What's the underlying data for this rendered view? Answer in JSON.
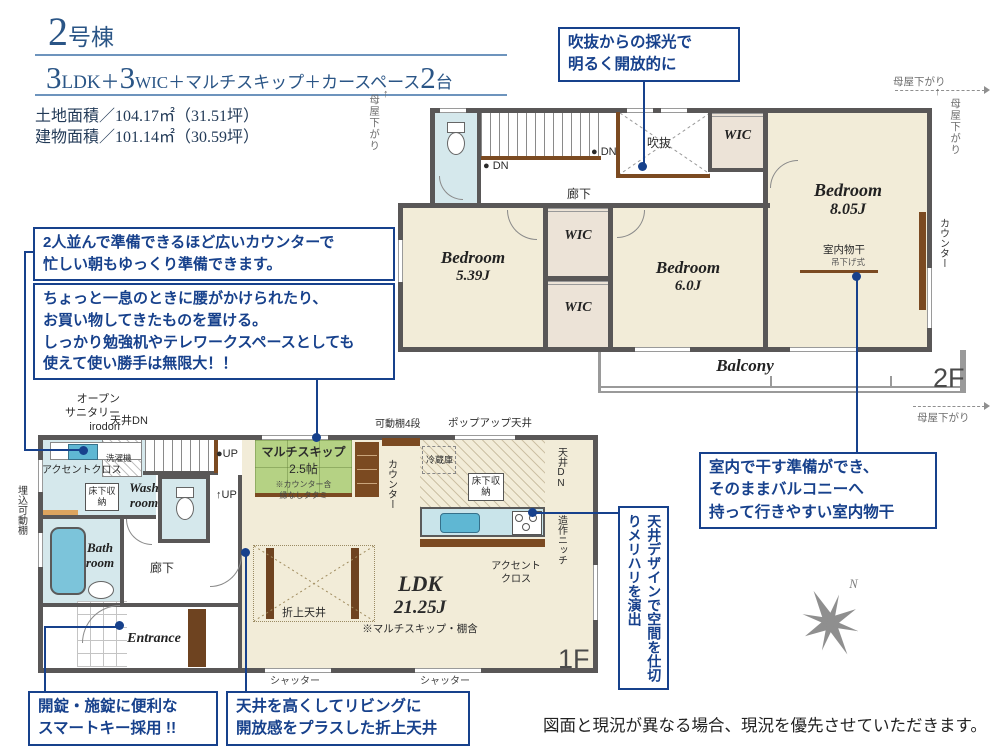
{
  "header": {
    "unit_number": "2",
    "unit_suffix": "号棟",
    "spec_num1": "3",
    "spec_txt1": "LDK＋",
    "spec_num2": "3",
    "spec_txt2": "WIC＋マルチスキップ＋カースペース",
    "spec_num3": "2",
    "spec_txt3": "台",
    "land_area": "土地面積／104.17㎡（31.51坪）",
    "building_area": "建物面積／101.14㎡（30.59坪）"
  },
  "callouts": {
    "void_light": "吹抜からの採光で\n明るく開放的に",
    "wide_counter": "2人並んで準備できるほど広いカウンターで\n忙しい朝もゆっくり準備できます。",
    "multi_skip_bench": "ちょっと一息のときに腰がかけられたり、\nお買い物してきたものを置ける。\nしっかり勉強机やテレワークスペースとしても\n使えて使い勝手は無限大！！",
    "indoor_drying": "室内で干す準備ができ、\nそのままバルコニーへ\n持って行きやすい室内物干",
    "ceiling_design": "天井デザインで空間を仕切りメリハリを演出",
    "smart_key": "開錠・施錠に便利な\nスマートキー採用 !!",
    "folded_ceiling": "天井を高くしてリビングに\n開放感をプラスした折上天井"
  },
  "plan2f": {
    "floor_label": "2F",
    "bedroom_a_name": "Bedroom",
    "bedroom_a_size": "8.05J",
    "bedroom_b_name": "Bedroom",
    "bedroom_b_size": "5.39J",
    "bedroom_c_name": "Bedroom",
    "bedroom_c_size": "6.0J",
    "wic": "WIC",
    "void": "吹抜",
    "corridor": "廊下",
    "dn": "DN",
    "balcony": "Balcony",
    "counter": "カウンター",
    "moya_sagari": "母屋下がり",
    "drying": "室内物干",
    "drying_sub": "吊下げ式"
  },
  "plan1f": {
    "floor_label": "1F",
    "ldk_name": "LDK",
    "ldk_size": "21.25J",
    "ldk_note": "※マルチスキップ・棚含",
    "ms_name": "マルチスキップ",
    "ms_size": "2.5帖",
    "ms_note1": "※カウンター含",
    "ms_note2": "縁なしタタミ",
    "bath": "Bath\nroom",
    "wash": "Wash\nroom",
    "entrance": "Entrance",
    "corridor": "廊下",
    "up": "UP",
    "oriage": "折上天井",
    "shutter": "シャッター",
    "kadoudana": "可動棚4段",
    "popup": "ポップアップ天井",
    "fridge": "冷蔵庫",
    "yukashita": "床下収納",
    "ceiling_dn": "天井DN",
    "zousaku": "造作ニッチ",
    "accent": "アクセントクロス",
    "accent2": "アクセント\nクロス",
    "counter": "カウンター",
    "umekomi": "埋込可動棚",
    "open_sanitary": "オープン\nサニタリー\nirodori",
    "washer": "洗濯機"
  },
  "compass": {
    "north": "N"
  },
  "footer": {
    "disclaimer": "図面と現況が異なる場合、現況を優先させていただきます。"
  },
  "colors": {
    "accent_blue": "#17418c",
    "title_navy": "#2a5586",
    "wall_gray": "#595757",
    "room_beige": "#f2ecd8",
    "wet_blue": "#d5e8ec",
    "tatami_green": "#b5d284",
    "wood_brown": "#7b4a21",
    "closet_beige": "#ece3d7"
  }
}
